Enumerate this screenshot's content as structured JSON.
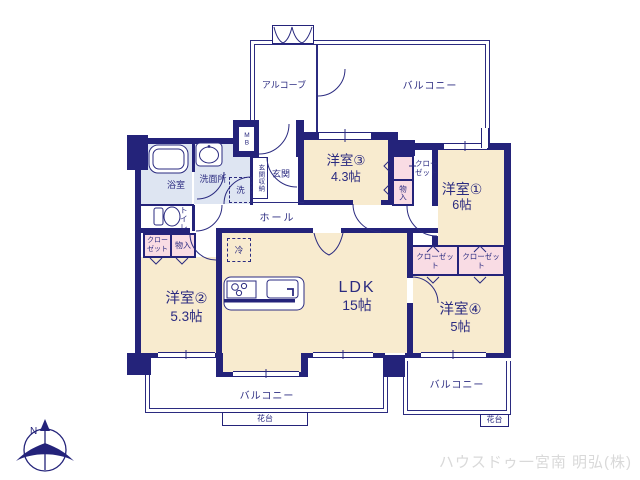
{
  "rooms": {
    "western3": {
      "name": "洋室③",
      "size": "4.3帖"
    },
    "western1": {
      "name": "洋室①",
      "size": "6帖"
    },
    "western2": {
      "name": "洋室②",
      "size": "5.3帖"
    },
    "western4": {
      "name": "洋室④",
      "size": "5帖"
    },
    "ldk": {
      "name": "LDK",
      "size": "15帖"
    }
  },
  "spaces": {
    "alcove": "アルコーブ",
    "balcony_top": "バルコニー",
    "balcony_bottom_left": "バルコニー",
    "balcony_bottom_right": "バルコニー",
    "flower_stand_left": "花台",
    "flower_stand_right": "花台",
    "hall": "ホール",
    "entrance": "玄関",
    "entrance_storage": "玄関収納",
    "meter_box": "MB",
    "bathroom": "浴室",
    "washroom": "洗面所",
    "toilet": "トイレ",
    "washer_space": "洗",
    "fridge_space": "冷"
  },
  "storage": {
    "closet_by_room3": "クロー\nゼット",
    "storage_by_room3": "物入",
    "closet_by_room2": "クロー\nゼット",
    "storage_by_room2": "物入",
    "closet_room4_left": "クローゼット",
    "closet_room4_right": "クローゼット"
  },
  "compass": {
    "north_label": "N"
  },
  "watermark": "ハウスドゥ一宮南 明弘(株)",
  "colors": {
    "wall": "#24237a",
    "text": "#2b2b80",
    "room_fill": "#f8ebcf",
    "wet_area_fill": "#dee5f2",
    "closet_fill": "#f9dce4",
    "watermark": "#d9d9d9"
  }
}
